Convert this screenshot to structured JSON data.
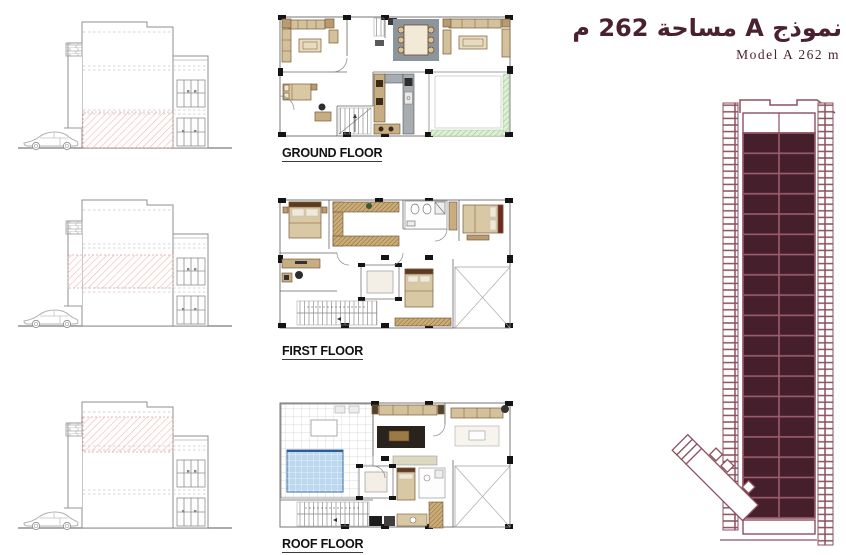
{
  "header": {
    "title_arabic": "نموذج A مساحة 262 م",
    "title_english": "Model A 262 m"
  },
  "floors": [
    {
      "label": "GROUND FLOOR"
    },
    {
      "label": "FIRST FLOOR"
    },
    {
      "label": "ROOF FLOOR"
    }
  ],
  "elevations": [
    {
      "highlighted_floor": "ground"
    },
    {
      "highlighted_floor": "first"
    },
    {
      "highlighted_floor": "roof"
    }
  ],
  "colors": {
    "accent_maroon": "#4a2130",
    "tower_cell_fill": "#451f2b",
    "tower_outline": "#8d5060",
    "highlight_hatch_pink": "#f2bcbc",
    "courtyard_green": "#cfe6c2",
    "pool_blue": "#bcd8ee",
    "furniture_tan": "#d2c19b",
    "wood_brown": "#c9ac78",
    "rug_gray": "#8d959c"
  }
}
